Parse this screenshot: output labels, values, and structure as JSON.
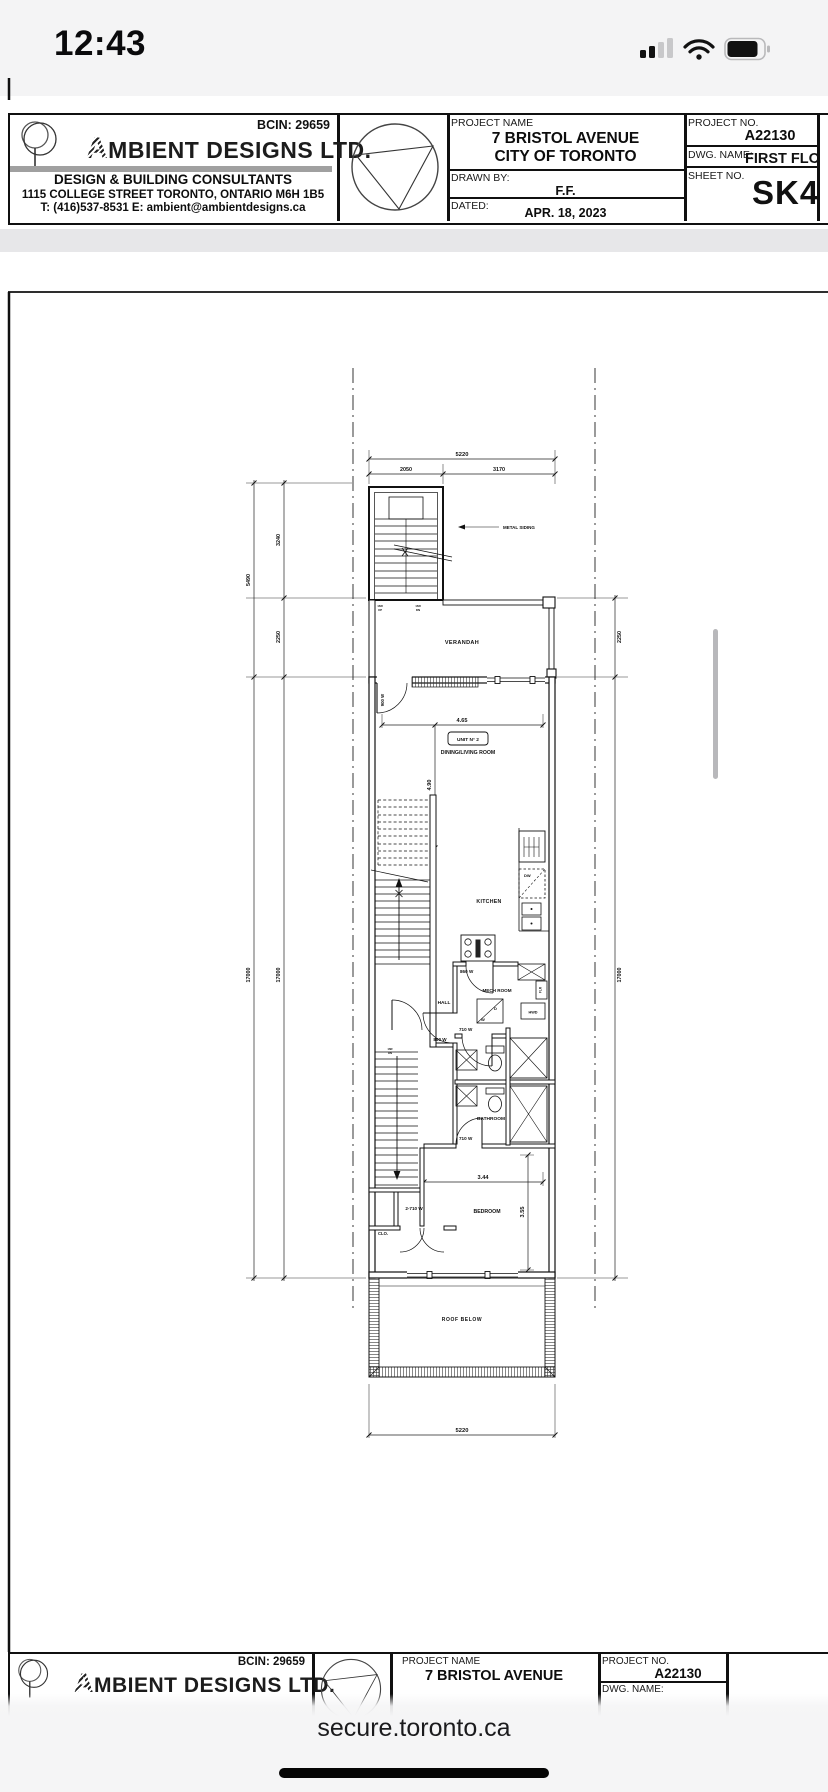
{
  "status_bar": {
    "time": "12:43"
  },
  "title_block": {
    "bcin": "BCIN: 29659",
    "company_initial": "A",
    "company_rest": "MBIENT DESIGNS LTD.",
    "tagline": "DESIGN & BUILDING CONSULTANTS",
    "address": "1115 COLLEGE STREET  TORONTO, ONTARIO  M6H 1B5",
    "contact": "T: (416)537-8531    E:  ambient@ambientdesigns.ca",
    "project_name_label": "PROJECT NAME",
    "project_name": "7 BRISTOL AVENUE",
    "project_city": "CITY OF TORONTO",
    "drawn_by_label": "DRAWN BY:",
    "drawn_by": "F.F.",
    "dated_label": "DATED:",
    "dated": "APR. 18, 2023",
    "project_no_label": "PROJECT NO.",
    "project_no": "A22130",
    "dwg_name_label": "DWG. NAME:",
    "dwg_name": "FIRST FLO",
    "sheet_no_label": "SHEET NO.",
    "sheet_no": "SK4"
  },
  "plan": {
    "unit_label": "UNIT N° 2",
    "note_metal_siding": "METAL SIDING",
    "rooms": {
      "verandah": "VERANDAH",
      "living": "DINING/LIVING ROOM",
      "kitchen": "KITCHEN",
      "hall": "HALL",
      "mech": "MECH ROOM",
      "bathroom": "BATHROOM",
      "bedroom": "BEDROOM",
      "closet": "CLO.",
      "roof": "ROOF BELOW"
    },
    "appliances": {
      "dishwasher": "DW",
      "hot_water": "HWD",
      "flr": "FLR",
      "washer": "W",
      "dryer": "D"
    },
    "doors": {
      "d900": "900 W",
      "d860": "860 W",
      "d710": "710 W",
      "d2710": "2-710 W"
    },
    "stairs": {
      "risers": "16R",
      "up": "UP",
      "dn": "DN"
    },
    "dims": {
      "overall_width": "5220",
      "front_left": "2050",
      "front_right": "3170",
      "left_total": "5490",
      "left_upper": "3240",
      "side_verandah": "2250",
      "lot_depth": "17000",
      "living_width": "4.65",
      "living_depth": "4.90",
      "bedroom_width": "3.44",
      "bedroom_depth": "3.55"
    }
  },
  "browser": {
    "url": "secure.toronto.ca"
  }
}
